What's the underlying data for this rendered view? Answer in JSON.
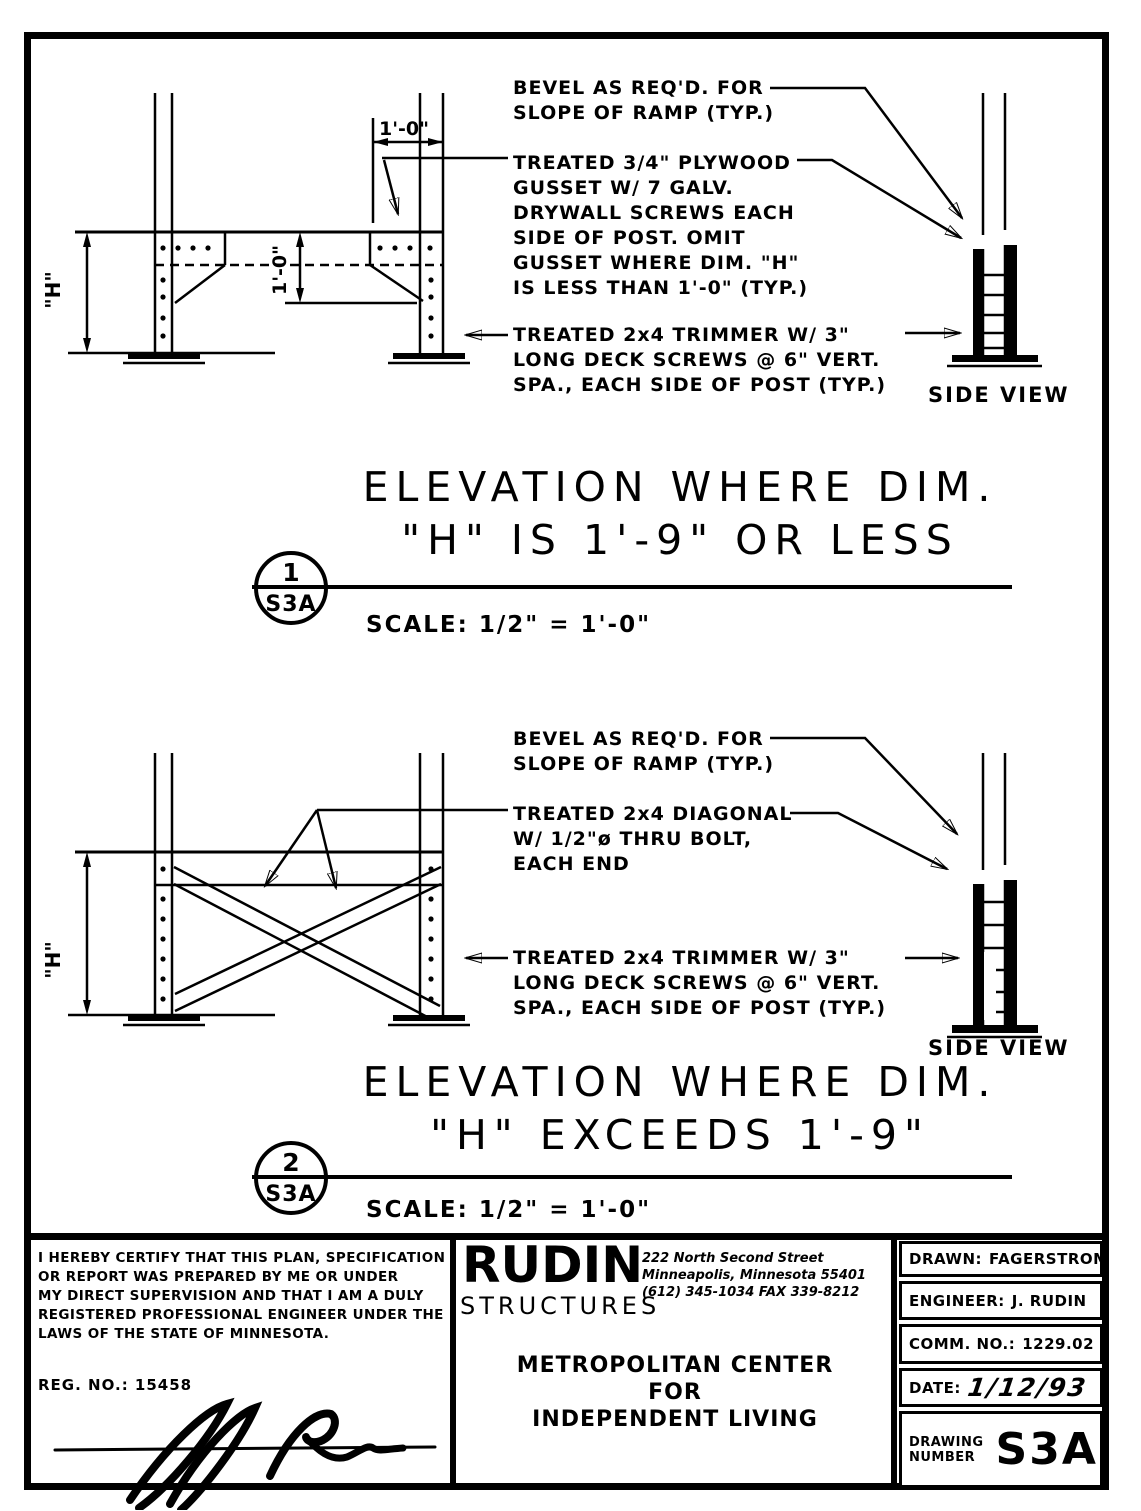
{
  "ink": "#000000",
  "d1": {
    "bevel": [
      "BEVEL AS REQ'D. FOR",
      "SLOPE OF RAMP (TYP.)"
    ],
    "gusset": [
      "TREATED 3/4\" PLYWOOD",
      "GUSSET W/ 7 GALV.",
      "DRYWALL SCREWS EACH",
      "SIDE OF POST. OMIT",
      "GUSSET WHERE DIM. \"H\"",
      "IS LESS THAN 1'-0\" (TYP.)"
    ],
    "trimmer": [
      "TREATED 2x4 TRIMMER W/ 3\"",
      "LONG DECK SCREWS @ 6\" VERT.",
      "SPA., EACH SIDE OF POST (TYP.)"
    ],
    "dim_top": "1'-0\"",
    "dim_mid": "1'-0\"",
    "dim_h": "\"H\"",
    "side_view": "SIDE VIEW",
    "title1": "ELEVATION WHERE DIM.",
    "title2": "\"H\" IS 1'-9\" OR LESS",
    "bubble_num": "1",
    "bubble_sheet": "S3A",
    "scale": "SCALE: 1/2\" = 1'-0\""
  },
  "d2": {
    "bevel": [
      "BEVEL AS REQ'D. FOR",
      "SLOPE OF RAMP (TYP.)"
    ],
    "diagonal": [
      "TREATED 2x4 DIAGONAL",
      "W/ 1/2\"ø THRU BOLT,",
      "EACH END"
    ],
    "trimmer": [
      "TREATED 2x4 TRIMMER W/ 3\"",
      "LONG DECK SCREWS @ 6\" VERT.",
      "SPA., EACH SIDE OF POST (TYP.)"
    ],
    "dim_h": "\"H\"",
    "side_view": "SIDE VIEW",
    "title1": "ELEVATION WHERE DIM.",
    "title2": "\"H\" EXCEEDS 1'-9\"",
    "bubble_num": "2",
    "bubble_sheet": "S3A",
    "scale": "SCALE: 1/2\" = 1'-0\""
  },
  "tb": {
    "cert": [
      "I HEREBY CERTIFY THAT THIS PLAN, SPECIFICATION",
      "OR REPORT WAS PREPARED BY ME OR UNDER",
      "MY DIRECT SUPERVISION AND THAT I AM A DULY",
      "REGISTERED PROFESSIONAL ENGINEER UNDER THE",
      "LAWS OF THE STATE OF MINNESOTA."
    ],
    "reg": "REG. NO.: 15458",
    "firm": "RUDIN",
    "firm_sub": "STRUCTURES",
    "addr": [
      "222 North Second Street",
      "Minneapolis, Minnesota 55401",
      "(612) 345-1034  FAX 339-8212"
    ],
    "project": [
      "METROPOLITAN CENTER",
      "FOR",
      "INDEPENDENT LIVING"
    ],
    "drawn_l": "DRAWN:",
    "drawn_v": "FAGERSTROM",
    "eng_l": "ENGINEER:",
    "eng_v": "J. RUDIN",
    "comm_l": "COMM. NO.:",
    "comm_v": "1229.02",
    "date_l": "DATE:",
    "date_v": "1/12/93",
    "dwg_l1": "DRAWING",
    "dwg_l2": "NUMBER",
    "dwg_v": "S3A"
  }
}
